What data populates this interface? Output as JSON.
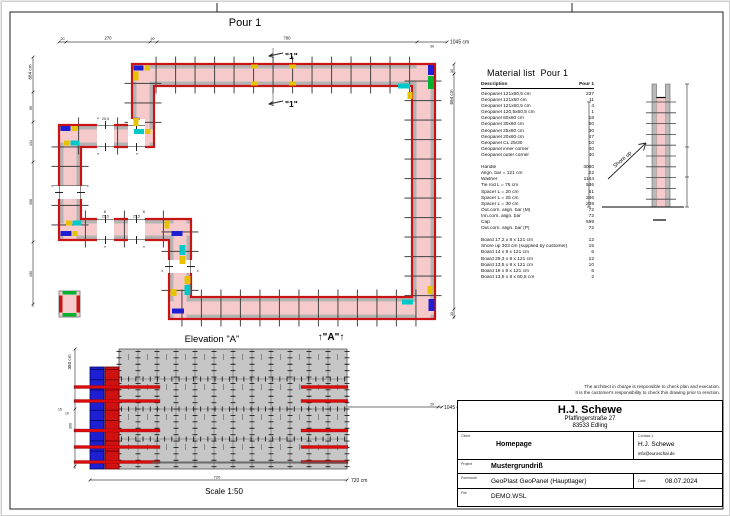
{
  "drawing": {
    "title": "Pour 1"
  },
  "plan": {
    "dims_top": {
      "seg20a": "20",
      "seg270": "270",
      "seg20b": "20",
      "seg780": "780",
      "seg30": "30",
      "total": "1045 cm"
    },
    "dims_left": {
      "total": "684 cm",
      "seg90": "90",
      "seg134": "134",
      "seg358": "358",
      "seg190": "190"
    },
    "dims_right": {
      "total": "694 cm",
      "seg30_top": "30",
      "seg30_bottom": "30"
    },
    "section_marker": "\"1\"",
    "opening_label": "25,5",
    "view_arrow": "↑\"A\"↑"
  },
  "section": {
    "shore_up_label": "Shore up"
  },
  "material_list": {
    "title": "Material list  Pour 1",
    "columns": {
      "description": "Description",
      "quantity": "Pour 1"
    },
    "rows": [
      [
        "Geopanel 121x60,5 cm",
        "237"
      ],
      [
        "Geopanel 121x60 cm",
        "11"
      ],
      [
        "Geopanel 121x60,5 cm",
        "4"
      ],
      [
        "Geopanel 120,5x60,5 cm",
        "1"
      ],
      [
        "Geopanel 60x60 cm",
        "18"
      ],
      [
        "Geopanel 30x60 cm",
        "50"
      ],
      [
        "Geopanel 25x60 cm",
        "30"
      ],
      [
        "Geopanel 20x60 cm",
        "47"
      ],
      [
        "Geopanel CL 25/30",
        "10"
      ],
      [
        "Geopanel inner corner",
        "40"
      ],
      [
        "Geopanel outer corner",
        "40"
      ],
      [
        "",
        ""
      ],
      [
        "Handle",
        "3080"
      ],
      [
        "Align. bar = 121 cm",
        "22"
      ],
      [
        "Washer",
        "1144"
      ],
      [
        "Tie rod L = 75 cm",
        "536"
      ],
      [
        "Spacer L = 20 cm",
        "51"
      ],
      [
        "Spacer L = 25 cm",
        "246"
      ],
      [
        "Spacer L = 30 cm",
        "239"
      ],
      [
        "Out.corn. align. bar (M)",
        "72"
      ],
      [
        "Inn.corn. align. bar",
        "72"
      ],
      [
        "Cap",
        "599"
      ],
      [
        "Out.corn. align. bar (P)",
        "72"
      ],
      [
        "",
        ""
      ],
      [
        "Board 17,2 x 8 x 121 cm",
        "12"
      ],
      [
        "Shore up 303 cm (supplied by customer)",
        "15"
      ],
      [
        "Board 14 x 8 x 121 cm",
        "6"
      ],
      [
        "Board 29,3 x 8 x 121 cm",
        "12"
      ],
      [
        "Board 13,5 x 8 x 121 cm",
        "10"
      ],
      [
        "Board 19 x 8 x 121 cm",
        "6"
      ],
      [
        "Board 13,5 x 8 x 60,5 cm",
        "2"
      ]
    ]
  },
  "elevation": {
    "title": "Elevation \"A\"",
    "scale": "Scale 1:50",
    "dims": {
      "height_total": "380 cm",
      "seg15": "15",
      "seg10": "10",
      "seg300": "300",
      "width": "720",
      "width_total": "720 cm",
      "seg20": "20",
      "continuation": "1045 cm"
    }
  },
  "notes": {
    "line1": "The architect in charge is responsible to check plan and execution.",
    "line2": "It is the customer's responsibility to check this drawing prior to erection."
  },
  "title_block": {
    "company": "H.J. Schewe",
    "address1": "Pfaffingerstraße 27",
    "address2": "83533 Edling",
    "client_label": "Client",
    "client": "Homepage",
    "contact_label": "Contact 1",
    "contact_name": "H.J. Schewe",
    "contact_email": "info@euroschal.de",
    "project_label": "Project",
    "project": "Mustergrundriß",
    "formwork_label": "Formwork",
    "formwork": "GeoPlast GeoPanel (Hauptlager)",
    "date_label": "Date",
    "date": "08.07.2024",
    "file_label": "File",
    "file": "DEMO.WSL"
  },
  "colors": {
    "wall_fill": "#f6caca",
    "formwork_red": "#c81414",
    "panel_gray": "#b4b4b4",
    "accent_blue": "#1e1ed2",
    "accent_cyan": "#00c8c8",
    "accent_yellow": "#e6c300",
    "accent_green": "#00b22d",
    "elevation_gray": "#c6c6c6",
    "waler_red": "#dd0c0c"
  }
}
